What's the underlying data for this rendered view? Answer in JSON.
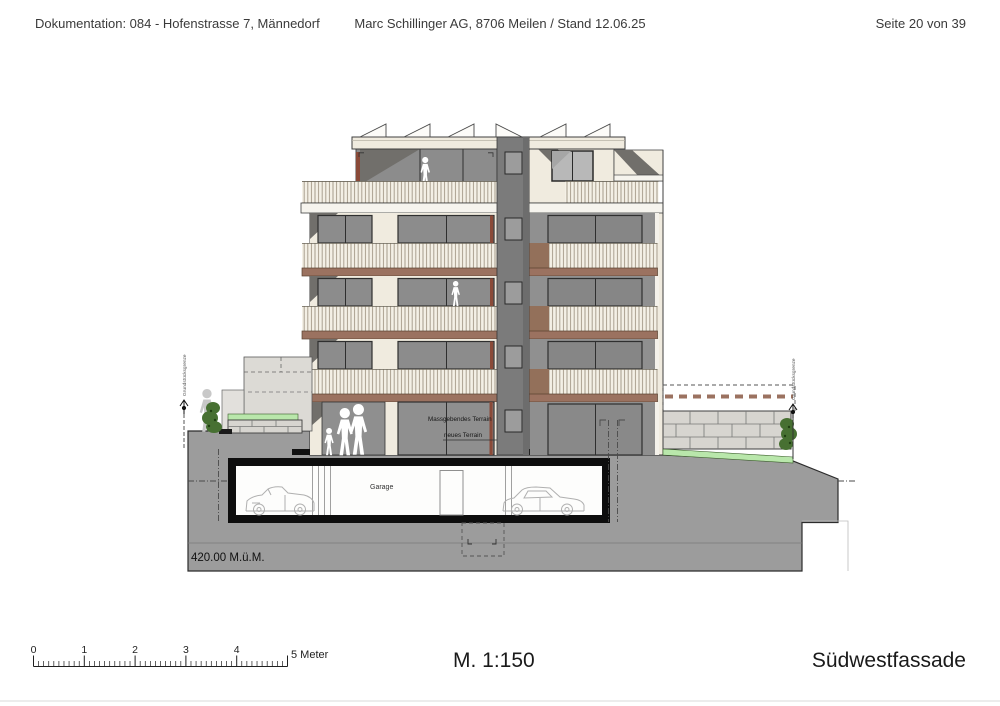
{
  "header": {
    "left": "Dokumentation: 084 - Hofenstrasse 7, Männedorf",
    "center": "Marc Schillinger AG, 8706 Meilen / Stand 12.06.25",
    "right": "Seite 20 von 39"
  },
  "footer": {
    "scale_text": "M. 1:150",
    "drawing_title": "Südwestfassade"
  },
  "scale_bar": {
    "numbers": [
      "0",
      "1",
      "2",
      "3",
      "4"
    ],
    "end_label": "5 Meter",
    "major_count": 5,
    "minor_per_major": 10
  },
  "annotations": {
    "terrain_existing": "Massgebendes Terrain",
    "terrain_new": "neues Terrain",
    "garage": "Garage",
    "elevation": "420.00 M.ü.M.",
    "property_boundary": "Grundstücksgrenze"
  },
  "colors": {
    "facade_cream": "#f0ebdf",
    "slat_bg": "#f4f0e6",
    "slat_line": "#a89e8d",
    "glazing": "#8c8c8c",
    "glazing_dark": "#868686",
    "window_frame": "#2f2f2f",
    "band_brown": "#9b7260",
    "accent_red": "#8a4a38",
    "core_gray": "#7b7b7b",
    "shadow_gray": "#716f6b",
    "terrain_gray": "#9c9c9c",
    "stone_gray": "#d7d5d0",
    "grass_green": "#b9e7ab",
    "shrub_green": "#477032",
    "garage_black": "#0e0e0e",
    "car_line": "#b0b0b0",
    "ink": "#1f1f1f"
  }
}
